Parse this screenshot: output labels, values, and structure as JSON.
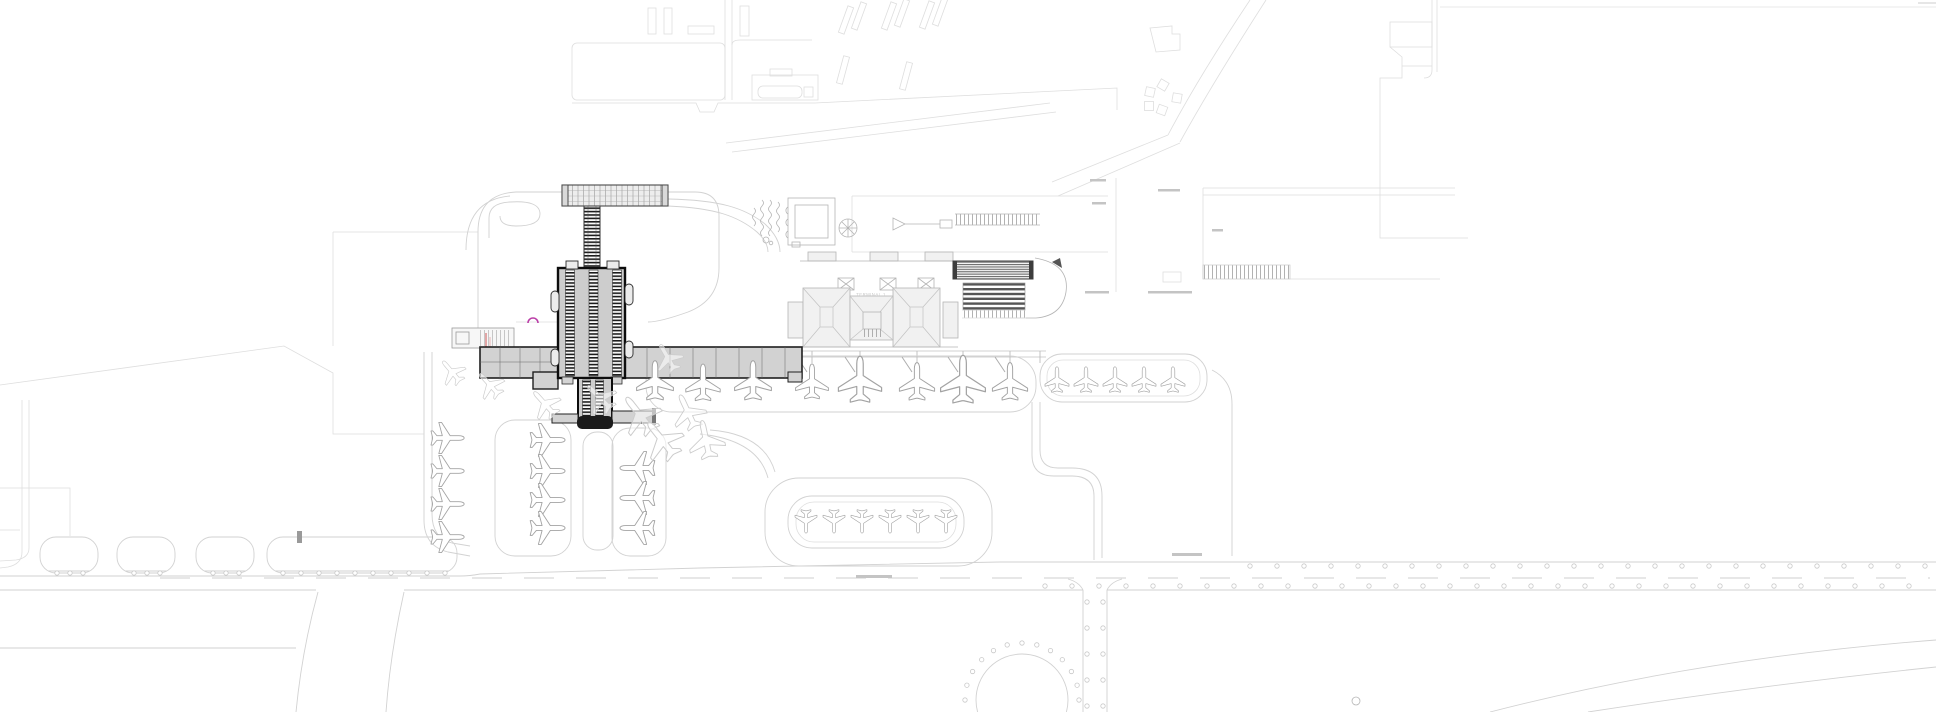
{
  "labels": {
    "terminal_1": "TERMINAL 1"
  },
  "colors": {
    "background": "#ffffff",
    "drawing_light": "#d6d6d6",
    "drawing_medium": "#9e9e9e",
    "building_fill": "#cdcdcd",
    "building_outline": "#111111",
    "hatch_dark": "#1c1c1c",
    "stripe_dark": "#565656",
    "accent_magenta": "#bb3fa8",
    "accent_red": "#cc5555",
    "aircraft_outline": "#a3a3a3"
  },
  "aircraft_groups": [
    {
      "name": "main-gate-row",
      "style": "plane",
      "planes": [
        [
          655,
          381,
          0,
          0.92
        ],
        [
          703,
          383,
          0,
          0.86
        ],
        [
          753,
          381,
          0,
          0.92
        ],
        [
          812,
          382,
          0,
          0.82
        ],
        [
          860,
          380,
          0,
          1.08
        ],
        [
          917,
          382,
          0,
          0.88
        ],
        [
          963,
          380,
          0,
          1.12
        ],
        [
          1010,
          382,
          0,
          0.88
        ]
      ]
    },
    {
      "name": "east-hardstand-row",
      "style": "plane",
      "planes": [
        [
          1057,
          380,
          0,
          0.6
        ],
        [
          1086,
          380,
          0,
          0.6
        ],
        [
          1115,
          380,
          0,
          0.6
        ],
        [
          1144,
          380,
          0,
          0.6
        ],
        [
          1173,
          380,
          0,
          0.6
        ]
      ]
    },
    {
      "name": "south-commuter-row",
      "style": "plane",
      "planes": [
        [
          806,
          521,
          180,
          0.55
        ],
        [
          834,
          521,
          180,
          0.55
        ],
        [
          862,
          521,
          180,
          0.55
        ],
        [
          890,
          521,
          180,
          0.55
        ],
        [
          918,
          521,
          180,
          0.55
        ],
        [
          946,
          521,
          180,
          0.55
        ]
      ]
    },
    {
      "name": "west-column-a",
      "style": "plane",
      "planes": [
        [
          447,
          438,
          90,
          0.78
        ],
        [
          447,
          471,
          90,
          0.78
        ],
        [
          447,
          504,
          90,
          0.78
        ],
        [
          447,
          537,
          90,
          0.78
        ]
      ]
    },
    {
      "name": "west-column-b",
      "style": "plane",
      "planes": [
        [
          547,
          440,
          90,
          0.82
        ],
        [
          547,
          471,
          90,
          0.82
        ],
        [
          547,
          500,
          90,
          0.82
        ],
        [
          547,
          528,
          90,
          0.82
        ]
      ]
    },
    {
      "name": "west-column-c",
      "style": "plane",
      "planes": [
        [
          638,
          468,
          -90,
          0.82
        ],
        [
          638,
          498,
          -90,
          0.82
        ],
        [
          638,
          528,
          -90,
          0.82
        ]
      ]
    },
    {
      "name": "ghost-positions",
      "style": "ghost",
      "planes": [
        [
          640,
          415,
          -38,
          1.0
        ],
        [
          662,
          440,
          -38,
          1.0
        ],
        [
          688,
          412,
          -25,
          0.85
        ],
        [
          706,
          440,
          -12,
          0.9
        ],
        [
          600,
          398,
          -45,
          0.78
        ],
        [
          545,
          404,
          -42,
          0.74
        ],
        [
          490,
          385,
          -42,
          0.68
        ],
        [
          452,
          372,
          -40,
          0.64
        ],
        [
          668,
          358,
          -30,
          0.7
        ]
      ]
    }
  ]
}
